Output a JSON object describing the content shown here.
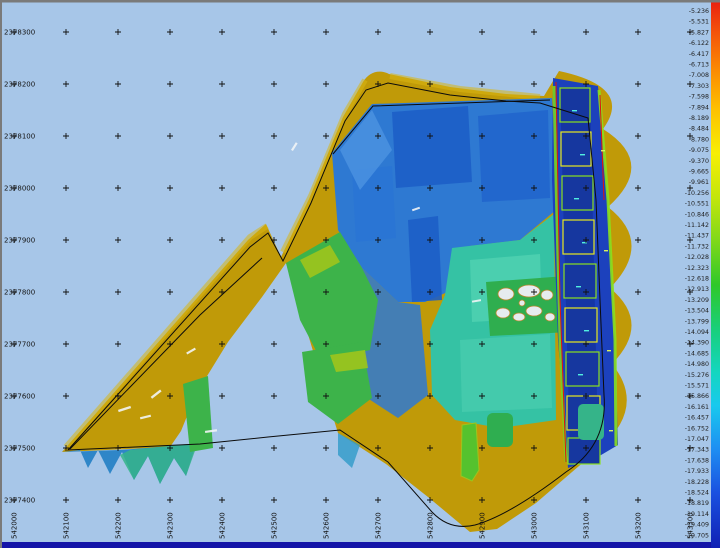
{
  "window": {
    "background_color": "#a7c6e8",
    "border_color": "#7a7a7a",
    "status_bar_color": "#1414a8"
  },
  "map": {
    "y_axis_labels": [
      "2378300",
      "2378200",
      "2378100",
      "2378000",
      "2377900",
      "2377800",
      "2377700",
      "2377600",
      "2377500",
      "2377400"
    ],
    "x_axis_labels": [
      "542000",
      "542100",
      "542200",
      "542300",
      "542400",
      "542500",
      "542600",
      "542700",
      "542800",
      "542900",
      "543000",
      "543100",
      "543200",
      "543300"
    ],
    "grid_cross_symbol": "+"
  },
  "colorbar": {
    "labels": [
      "-5.236",
      "-5.531",
      "-5.827",
      "-6.122",
      "-6.417",
      "-6.713",
      "-7.008",
      "-7.303",
      "-7.598",
      "-7.894",
      "-8.189",
      "-8.484",
      "-8.780",
      "-9.075",
      "-9.370",
      "-9.665",
      "-9.961",
      "-10.256",
      "-10.551",
      "-10.846",
      "-11.142",
      "-11.437",
      "-11.732",
      "-12.028",
      "-12.323",
      "-12.618",
      "-12.913",
      "-13.209",
      "-13.504",
      "-13.799",
      "-14.094",
      "-14.390",
      "-14.685",
      "-14.980",
      "-15.276",
      "-15.571",
      "-15.866",
      "-16.161",
      "-16.457",
      "-16.752",
      "-17.047",
      "-17.343",
      "-17.638",
      "-17.933",
      "-18.228",
      "-18.524",
      "-18.819",
      "-19.114",
      "-19.409",
      "-19.705"
    ],
    "gradient": [
      {
        "offset": 0.0,
        "color": "#e81e10"
      },
      {
        "offset": 0.06,
        "color": "#f4540a"
      },
      {
        "offset": 0.13,
        "color": "#fb8c03"
      },
      {
        "offset": 0.2,
        "color": "#fdc101"
      },
      {
        "offset": 0.28,
        "color": "#f7ef04"
      },
      {
        "offset": 0.36,
        "color": "#c3e60b"
      },
      {
        "offset": 0.44,
        "color": "#7fd81a"
      },
      {
        "offset": 0.52,
        "color": "#2fc829"
      },
      {
        "offset": 0.6,
        "color": "#19cf7a"
      },
      {
        "offset": 0.68,
        "color": "#14d6c0"
      },
      {
        "offset": 0.74,
        "color": "#19c9ee"
      },
      {
        "offset": 0.82,
        "color": "#1e8ef2"
      },
      {
        "offset": 0.9,
        "color": "#1a50e0"
      },
      {
        "offset": 1.0,
        "color": "#1020b4"
      }
    ]
  },
  "palette": {
    "shallow_olive": "#c09a08",
    "green": "#3db34a",
    "teal": "#35c2a4",
    "blue": "#2e79d2",
    "deep_blue": "#1c41bd",
    "background_water": "#a7c6e8"
  }
}
